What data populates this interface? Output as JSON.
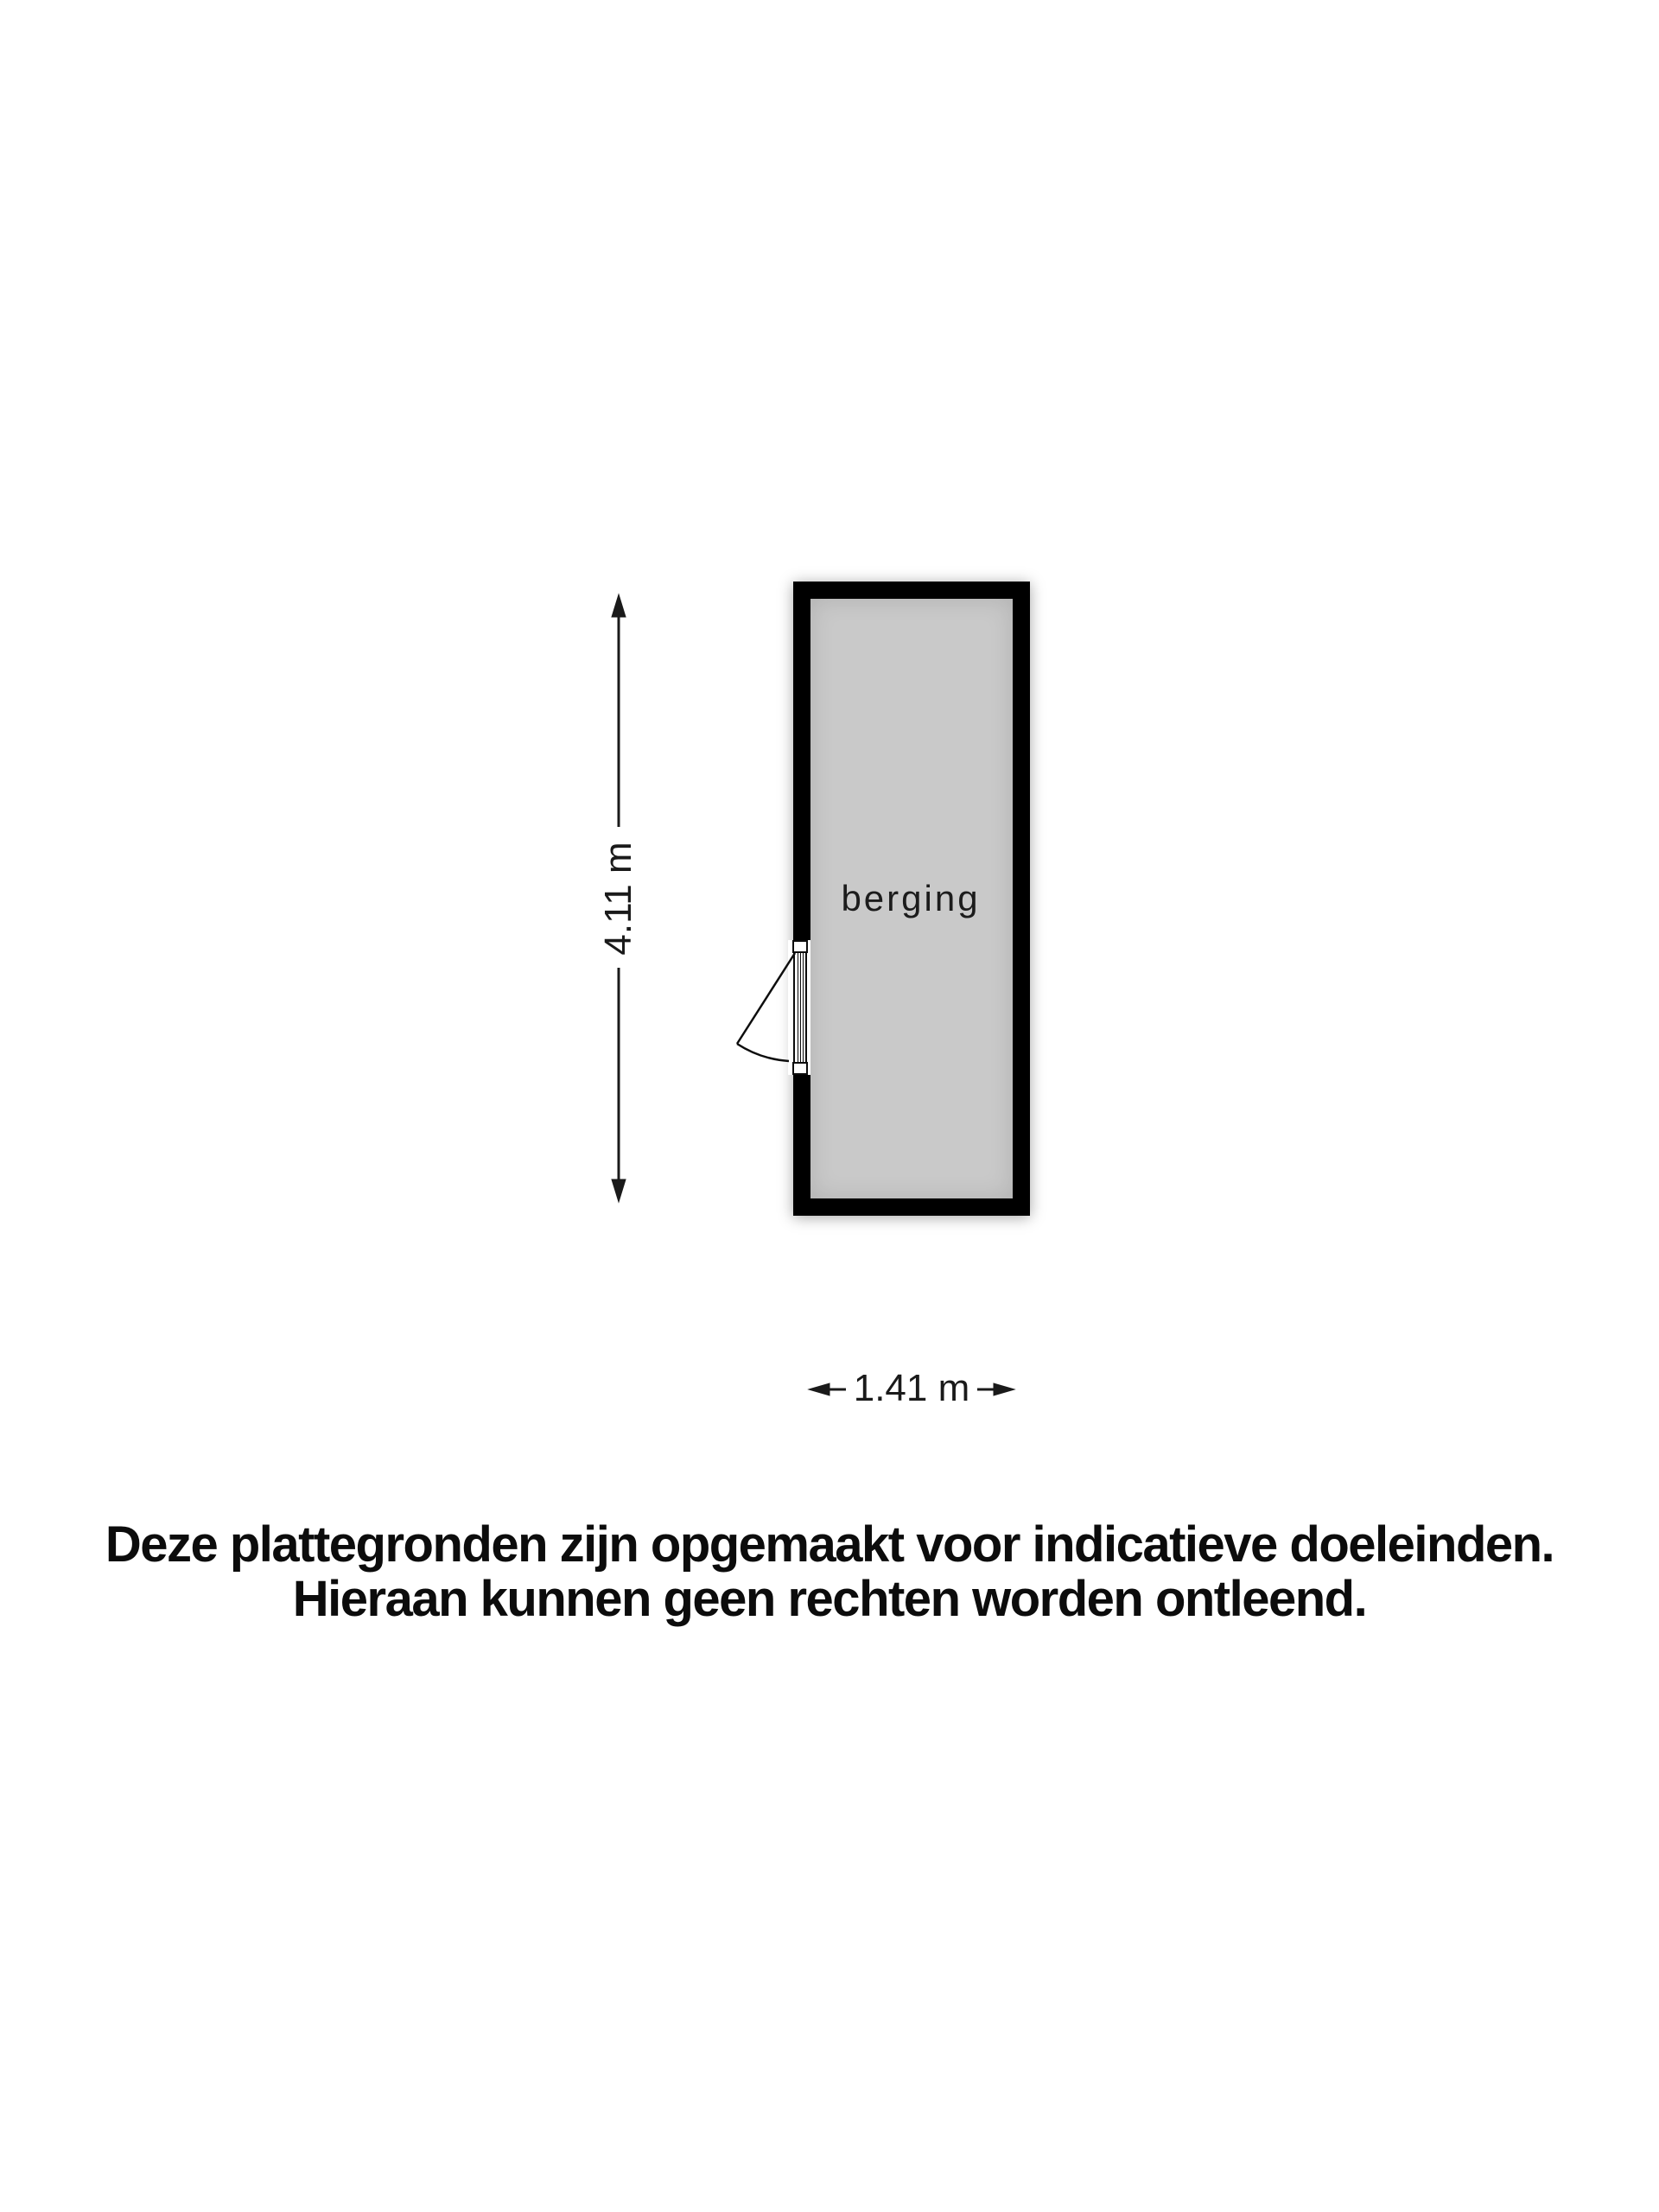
{
  "floorplan": {
    "room": {
      "label": "berging"
    },
    "dimensions": {
      "height": "4.11 m",
      "width": "1.41 m"
    },
    "colors": {
      "wall": "#000000",
      "floor": "#c9c9c9",
      "line": "#1a1a1a",
      "background": "#ffffff"
    }
  },
  "disclaimer": {
    "line1": "Deze plattegronden zijn opgemaakt voor indicatieve doeleinden.",
    "line2": "Hieraan kunnen geen rechten worden ontleend."
  }
}
